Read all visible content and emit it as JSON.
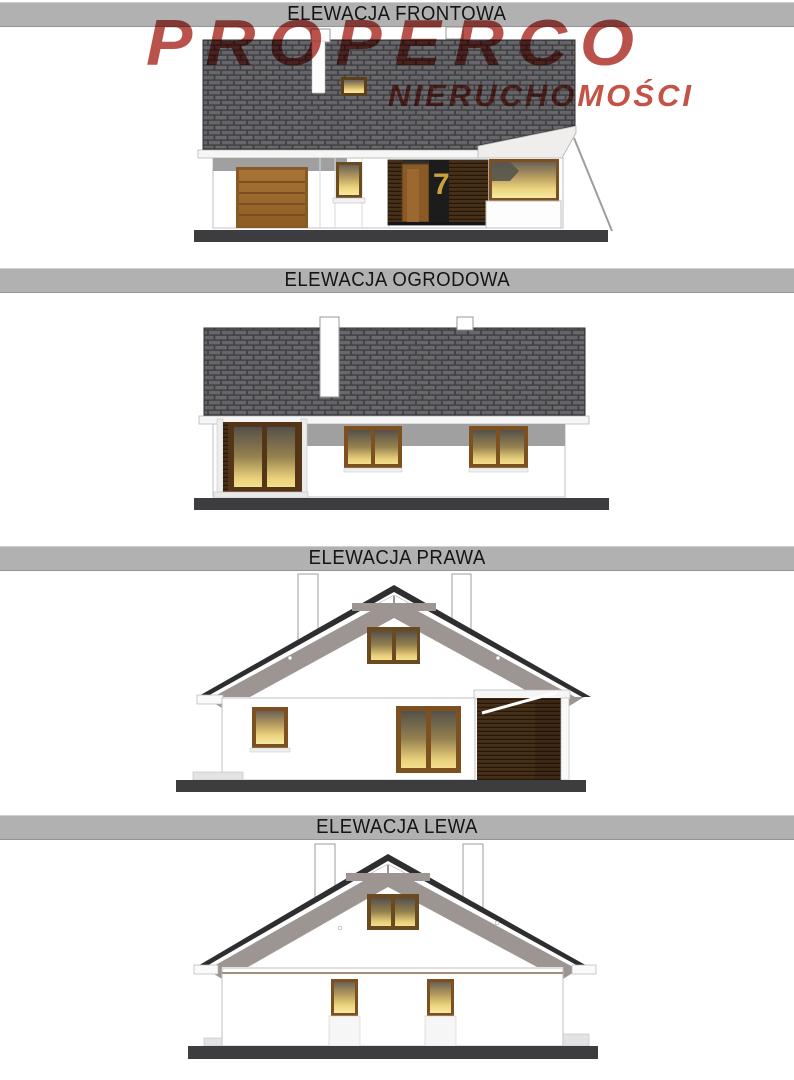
{
  "logo": {
    "brand": "PROPERCO",
    "subtitle": "NIERUCHOMOŚCI",
    "brand_color": "#b4453c",
    "subtitle_color": "#c1483c"
  },
  "sections": [
    {
      "title": "ELEWACJA FRONTOWA",
      "house_number": "7"
    },
    {
      "title": "ELEWACJA OGRODOWA"
    },
    {
      "title": "ELEWACJA PRAWA"
    },
    {
      "title": "ELEWACJA LEWA"
    }
  ],
  "colors": {
    "titlebar_bg": "#b1b1b1",
    "title_text": "#141414",
    "roof_shingle": "#66666a",
    "roof_gap": "#3e3e41",
    "roof_underside": "#9d9591",
    "bargeboard": "#2e2e30",
    "wall": "#ffffff",
    "wall_band_gray": "#a0a0a0",
    "wood_frame": "#7c511f",
    "wood_dark_slats": "#47301a",
    "garage_door": "#9d6a2e",
    "window_glow_top": "#5f574c",
    "window_glow_bottom": "#f6e9a2",
    "house_number_color": "#c9a23a",
    "ground": "#3d3d3f"
  }
}
